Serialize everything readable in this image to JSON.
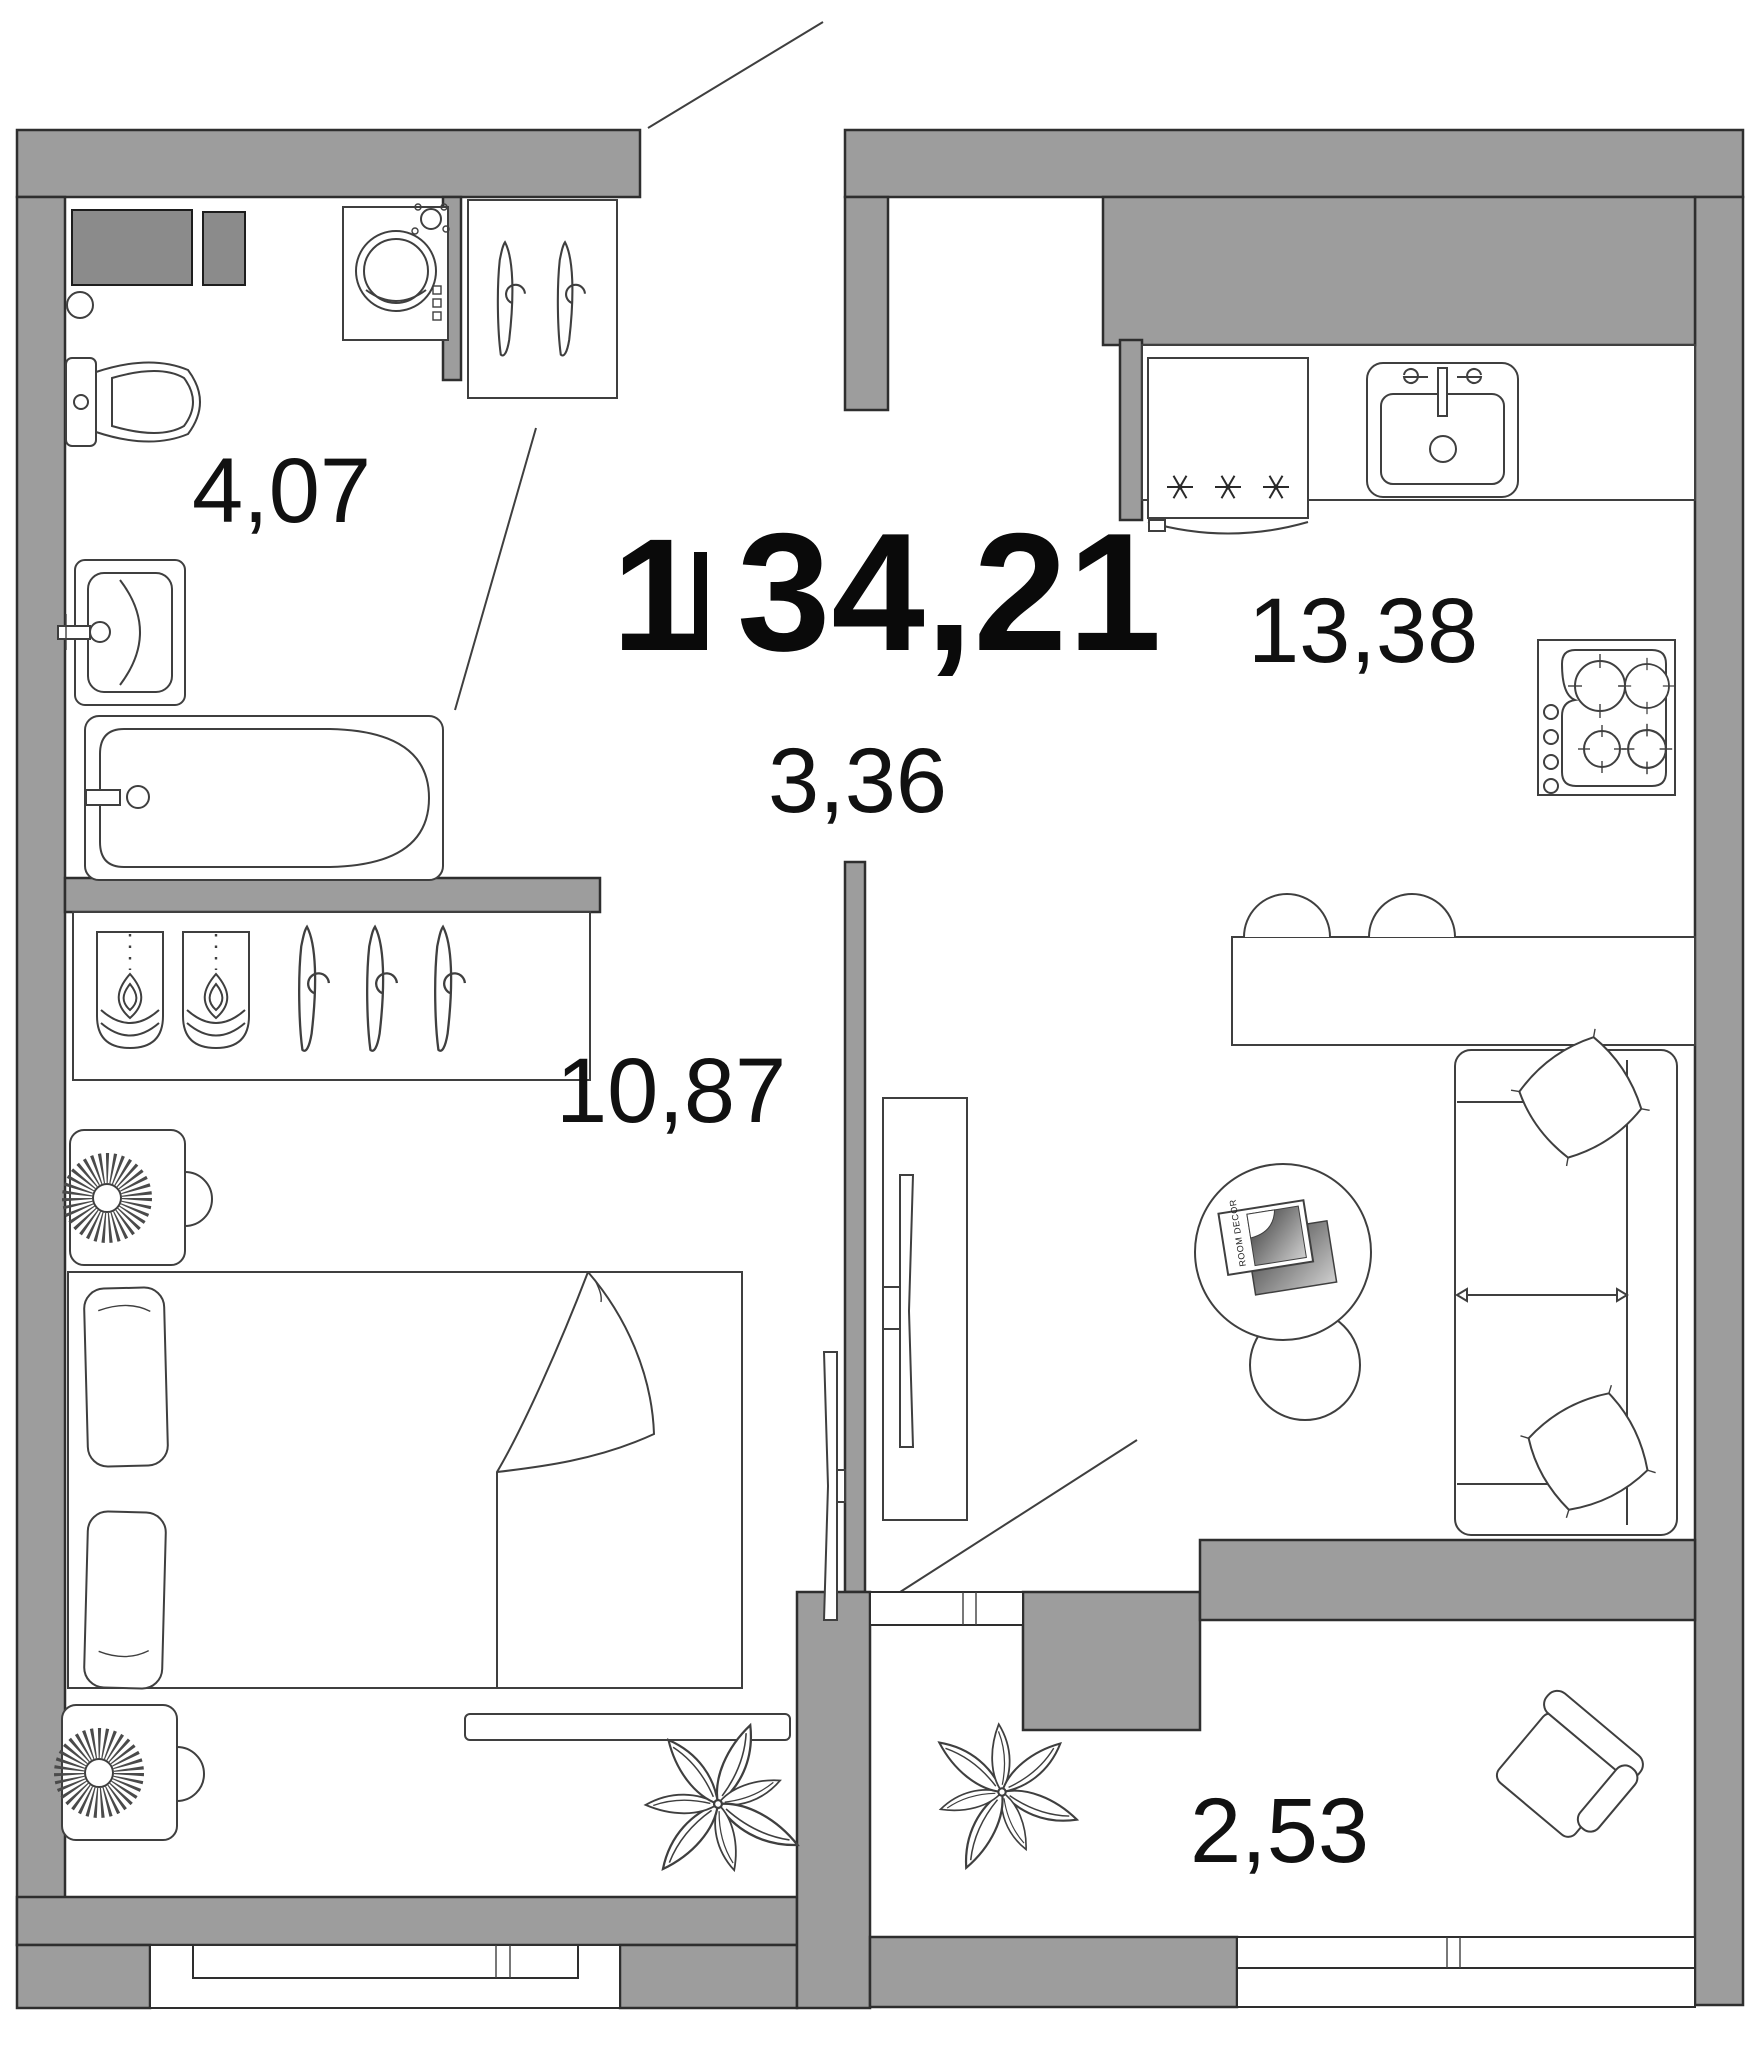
{
  "plan": {
    "type": "apartment-floor-plan",
    "title": {
      "rooms_count": "1",
      "total_area": "34,21"
    },
    "area_labels": {
      "kitchen_living": "13,38",
      "hallway": "3,36",
      "bathroom": "4,07",
      "bedroom": "10,87",
      "balcony": "2,53"
    },
    "coffee_table": {
      "magazine_text": "ROOM DECOR"
    },
    "colors": {
      "wall": "#9D9D9D",
      "vent_shaft": "#8B8B8B",
      "outline": "#2E2E2E",
      "furniture_line": "#3F3F3F",
      "text": "#111111",
      "background": "#FFFFFF"
    },
    "furniture": {
      "bathroom": [
        "vent-shaft",
        "washing-machine",
        "floor-drain",
        "toilet",
        "sink",
        "bathtub"
      ],
      "hallway": [
        "coat-shelf-with-hangers"
      ],
      "kitchen": [
        "fridge-freezer",
        "kitchen-counter",
        "kitchen-sink",
        "stove-4-burner",
        "peninsula-counter",
        "bar-stool",
        "bar-stool"
      ],
      "living": [
        "tv-stand",
        "tv-living-side",
        "tv-bedroom-side",
        "coffee-table",
        "pouf",
        "magazines",
        "sofa-with-pillows"
      ],
      "bedroom": [
        "wardrobe-folded-clothes-hangers",
        "nightstand-lamp",
        "double-bed",
        "bed-bench",
        "plant"
      ],
      "balcony": [
        "plant",
        "armchair"
      ]
    }
  }
}
